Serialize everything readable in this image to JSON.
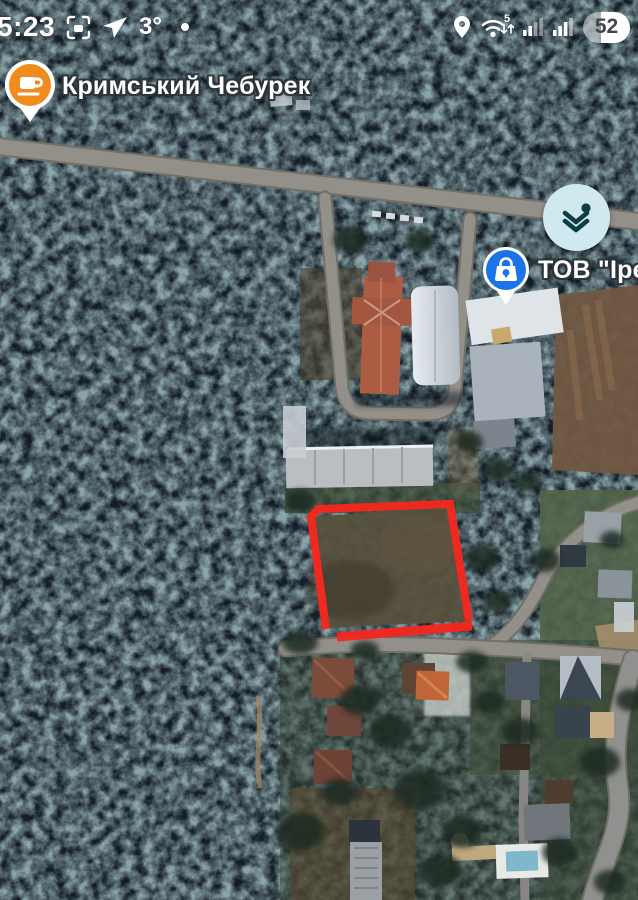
{
  "status_bar": {
    "time": "5:23",
    "temperature": "3°",
    "wifi_generation": "5",
    "battery_percent": "52",
    "left_icons": [
      "screen-capture-icon",
      "navigation-send-icon"
    ],
    "right_icons": [
      "location-pin-icon",
      "wifi-icon",
      "signal-bars-icon",
      "signal-bars-icon",
      "battery-indicator"
    ]
  },
  "map": {
    "type": "satellite",
    "poi_labels": [
      {
        "name": "Кримський Чебурек",
        "category": "cafe",
        "pin_color": "#f08c1e",
        "pin_icon": "coffee-cup"
      },
      {
        "name": "ТОВ \"Іре",
        "category": "shopping",
        "pin_color": "#1a73e8",
        "pin_icon": "shopping-bag"
      }
    ],
    "controls": {
      "layers_button_icon": "layers-icon"
    },
    "plot_outline": {
      "color": "#f5281e",
      "shape": "quadrilateral land plot beside road"
    },
    "colors": {
      "forest": "#1b2631",
      "road": "#929089",
      "lawn": "#53644a",
      "dirt_field": "#715741",
      "layers_button_bg": "#cfe9ee",
      "layers_glyph": "#0d3c47"
    }
  }
}
